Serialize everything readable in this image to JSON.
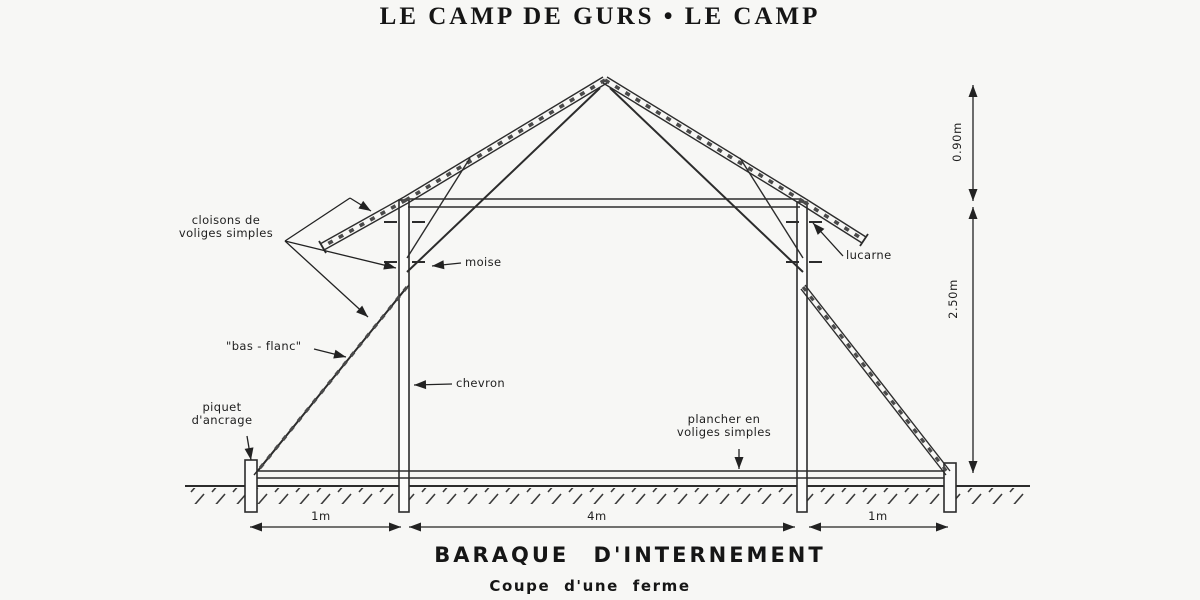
{
  "page": {
    "title": "LE CAMP DE GURS • LE CAMP"
  },
  "diagram": {
    "labels": {
      "cloisons_line1": "cloisons de",
      "cloisons_line2": "voliges simples",
      "moise": "moise",
      "lucarne": "lucarne",
      "bas_flanc": "\"bas - flanc\"",
      "chevron": "chevron",
      "piquet_line1": "piquet",
      "piquet_line2": "d'ancrage",
      "plancher_line1": "plancher en",
      "plancher_line2": "voliges simples"
    },
    "dimensions": {
      "ridge_height": "0.90m",
      "wall_height": "2.50m",
      "left_span": "1m",
      "center_span": "4m",
      "right_span": "1m"
    },
    "captions": {
      "title": "BARAQUE D'INTERNEMENT",
      "subtitle": "Coupe d'une ferme"
    },
    "colors": {
      "ink": "#222222",
      "paper": "#f7f7f5"
    }
  }
}
